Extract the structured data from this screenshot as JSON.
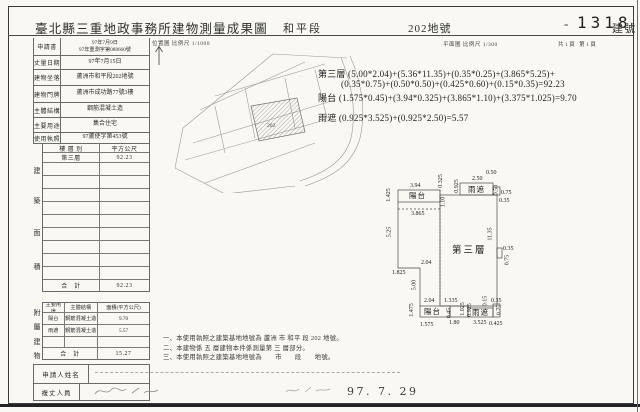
{
  "header": {
    "title": "臺北縣三重地政事務所建物測量成果圖",
    "section": "和平段",
    "parcel": "202地號",
    "dash": "-",
    "building_no": "1318",
    "building_no_suffix": "建號"
  },
  "subheader": {
    "location_map_label": "位置圖 比例尺 1/1000",
    "floor_plan_label": "平面圖 比例尺 1/300",
    "page_label": "共1頁 第1頁"
  },
  "form": {
    "rows": [
      {
        "label": "申請書",
        "value": "97年7月9日\n97年重測字第088660號"
      },
      {
        "label": "丈量日期",
        "value": "97年7月15日"
      },
      {
        "label": "建物坐落",
        "value": "蘆洲市和平段202地號"
      },
      {
        "label": "建物門牌",
        "value": "蘆洲市成功路77號3樓"
      },
      {
        "label": "主體結構",
        "value": "鋼筋混凝土造"
      },
      {
        "label": "主要用途",
        "value": "集合住宅"
      },
      {
        "label": "使用執照",
        "value": "97蘆使字第453號"
      }
    ]
  },
  "area_table": {
    "side_label": "建築面積",
    "headers": [
      "樓 層 別",
      "平方公尺"
    ],
    "rows": [
      [
        "第三層",
        "92.23"
      ]
    ],
    "total_label": "合　計",
    "total_value": "92.23"
  },
  "annex_table": {
    "side_label": "附屬建物",
    "headers": [
      "主要用途",
      "主體結構",
      "面積(平方公尺)"
    ],
    "rows": [
      [
        "陽台",
        "鋼筋混凝土造",
        "9.70"
      ],
      [
        "雨遮",
        "鋼筋混凝土造",
        "5.57"
      ]
    ],
    "total_label": "合　計",
    "total_value": "15.27"
  },
  "signature": {
    "applicant_label": "申請人姓名",
    "surveyor_label": "複丈人員"
  },
  "calculations": {
    "line1": "第三層 (5.00*2.04)+(5.36*11.35)+(0.35*0.25)+(3.865*5.25)+",
    "line2": "(0.35*0.75)+(0.50*0.50)+(0.425*0.60)+(0.15*0.35)=92.23",
    "line3": "陽台 (1.575*0.45)+(3.94*0.325)+(3.865*1.10)+(3.375*1.025)=9.70",
    "line4": "雨遮 (0.925*3.525)+(0.925*2.50)=5.57"
  },
  "notes": [
    "一、本使用執照之建築基地地號為 蘆洲 市 和平 段 202 地號。",
    "二、本建物係 五 層建物本件係測量第 三 層部分。",
    "三、本使用執照之建築基地地號為　　市　　段　　地號。"
  ],
  "map": {
    "parcel_label": "202"
  },
  "date_stamp": "97. 7. 29",
  "plan": {
    "labels": [
      {
        "text": "3.94",
        "x": 30,
        "y": 18
      },
      {
        "text": "陽台",
        "x": 29,
        "y": 27,
        "room": true
      },
      {
        "text": "1.425",
        "x": 2,
        "y": 27,
        "rot": true
      },
      {
        "text": "3.865",
        "x": 31,
        "y": 46
      },
      {
        "text": "0.325",
        "x": 54,
        "y": 13,
        "rot": true
      },
      {
        "text": "1.10",
        "x": 58,
        "y": 34,
        "rot": true
      },
      {
        "text": "0.925",
        "x": 70,
        "y": 18,
        "rot": true
      },
      {
        "text": "雨遮",
        "x": 88,
        "y": 21,
        "room": true
      },
      {
        "text": "2.50",
        "x": 92,
        "y": 11
      },
      {
        "text": "0.50",
        "x": 106,
        "y": 5
      },
      {
        "text": "0.50",
        "x": 111,
        "y": 22,
        "rot": true
      },
      {
        "text": "0.75",
        "x": 121,
        "y": 25
      },
      {
        "text": "0.35",
        "x": 119,
        "y": 33
      },
      {
        "text": "5.25",
        "x": 4,
        "y": 64,
        "rot": true
      },
      {
        "text": "第三層",
        "x": 72,
        "y": 82,
        "big": true
      },
      {
        "text": "11.35",
        "x": 104,
        "y": 66,
        "rot": true
      },
      {
        "text": "0.35",
        "x": 123,
        "y": 81
      },
      {
        "text": "0.75",
        "x": 122,
        "y": 92,
        "rot": true
      },
      {
        "text": "2.04",
        "x": 41,
        "y": 95
      },
      {
        "text": "1.825",
        "x": 12,
        "y": 105
      },
      {
        "text": "5.00",
        "x": 29,
        "y": 117,
        "rot": true
      },
      {
        "text": "2.04",
        "x": 44,
        "y": 133
      },
      {
        "text": "1.335",
        "x": 64,
        "y": 133
      },
      {
        "text": "陽台",
        "x": 44,
        "y": 143,
        "room": true
      },
      {
        "text": "1.475",
        "x": 25,
        "y": 142,
        "rot": true
      },
      {
        "text": "0.45",
        "x": 64,
        "y": 145,
        "rot": true
      },
      {
        "text": "1.80",
        "x": 69,
        "y": 155
      },
      {
        "text": "1.025",
        "x": 76,
        "y": 141,
        "rot": true
      },
      {
        "text": "1.575",
        "x": 40,
        "y": 157
      },
      {
        "text": "0.925",
        "x": 83,
        "y": 142,
        "rot": true
      },
      {
        "text": "雨遮",
        "x": 92,
        "y": 144,
        "room": true
      },
      {
        "text": "3.525",
        "x": 93,
        "y": 155
      },
      {
        "text": "0.15",
        "x": 100,
        "y": 133,
        "rot": true
      },
      {
        "text": "0.35",
        "x": 111,
        "y": 133
      },
      {
        "text": "0.75",
        "x": 114,
        "y": 142,
        "rot": true
      },
      {
        "text": "0.425",
        "x": 109,
        "y": 156
      }
    ]
  }
}
